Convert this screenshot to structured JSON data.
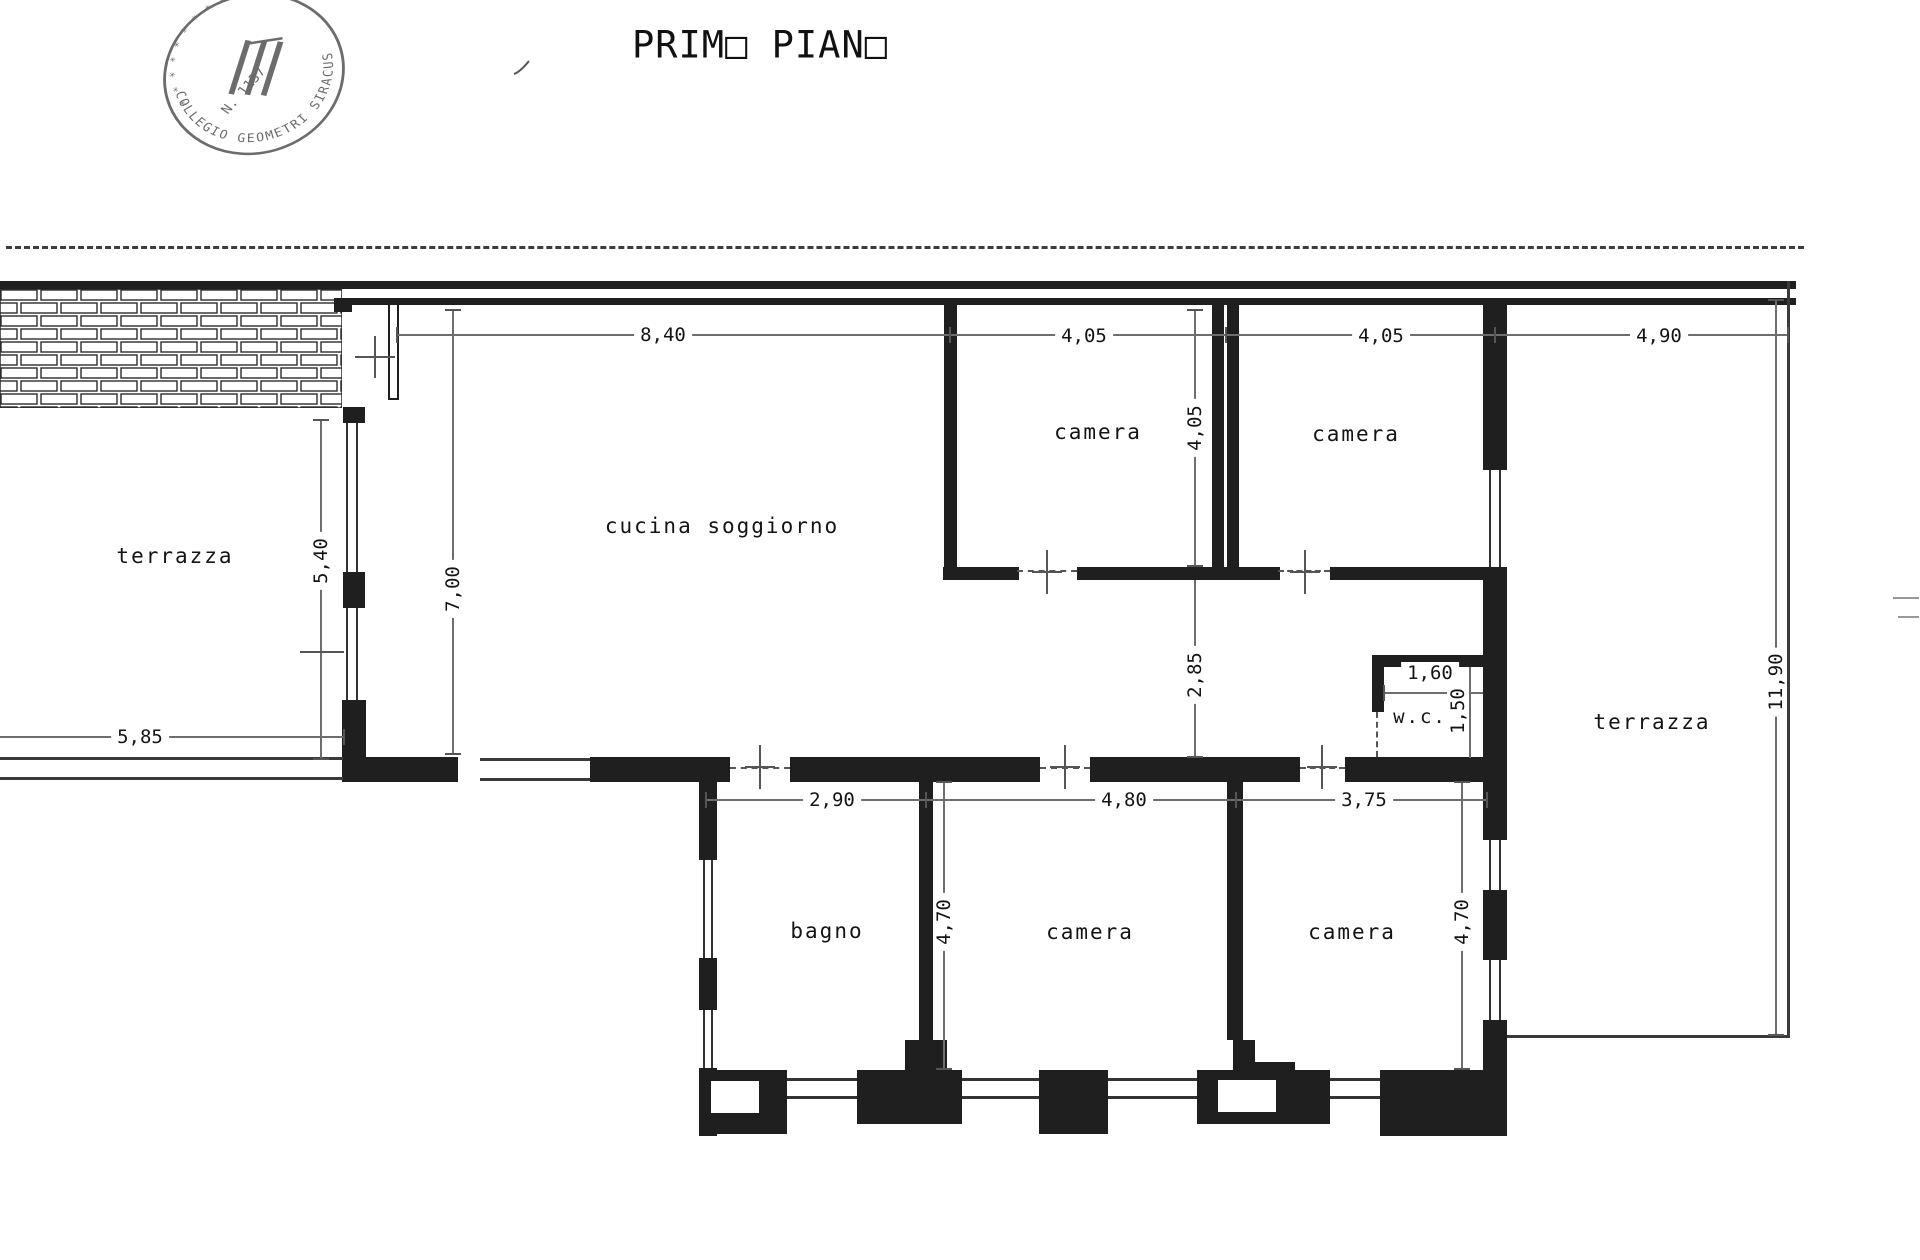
{
  "title": {
    "text": "PRIMO PIANO",
    "display": "PRIM□ PIAN□"
  },
  "stamp": {
    "ring_text": "COLLEGIO GEOMETRI SIRACUSA",
    "upper_text": "✳ ✳ ✳ ✳ ✳ ✳ ✳ ✳ ✳ UGO",
    "number": "N. 1137"
  },
  "rooms": {
    "terrazza_left": "terrazza",
    "cucina": "cucina soggiorno",
    "camera_top_left": "camera",
    "camera_top_right": "camera",
    "terrazza_right": "terrazza",
    "wc": "w.c.",
    "bagno": "bagno",
    "camera_bottom_mid": "camera",
    "camera_bottom_right": "camera"
  },
  "dims": {
    "cucina_width": "8,40",
    "camera1_width": "4,05",
    "camera1_height": "4,05",
    "camera2_width": "4,05",
    "terrace_right_width": "4,90",
    "terrace_left_height": "5,40",
    "cucina_height": "7,00",
    "terrace_left_width": "5,85",
    "corridor_width": "2,85",
    "terrace_right_height": "11,90",
    "wc_width": "1,60",
    "wc_height": "1,50",
    "bagno_width": "2,90",
    "camera_mid_width": "4,80",
    "camera_right_width": "3,75",
    "rooms_depth_left": "4,70",
    "rooms_depth_right": "4,70"
  }
}
